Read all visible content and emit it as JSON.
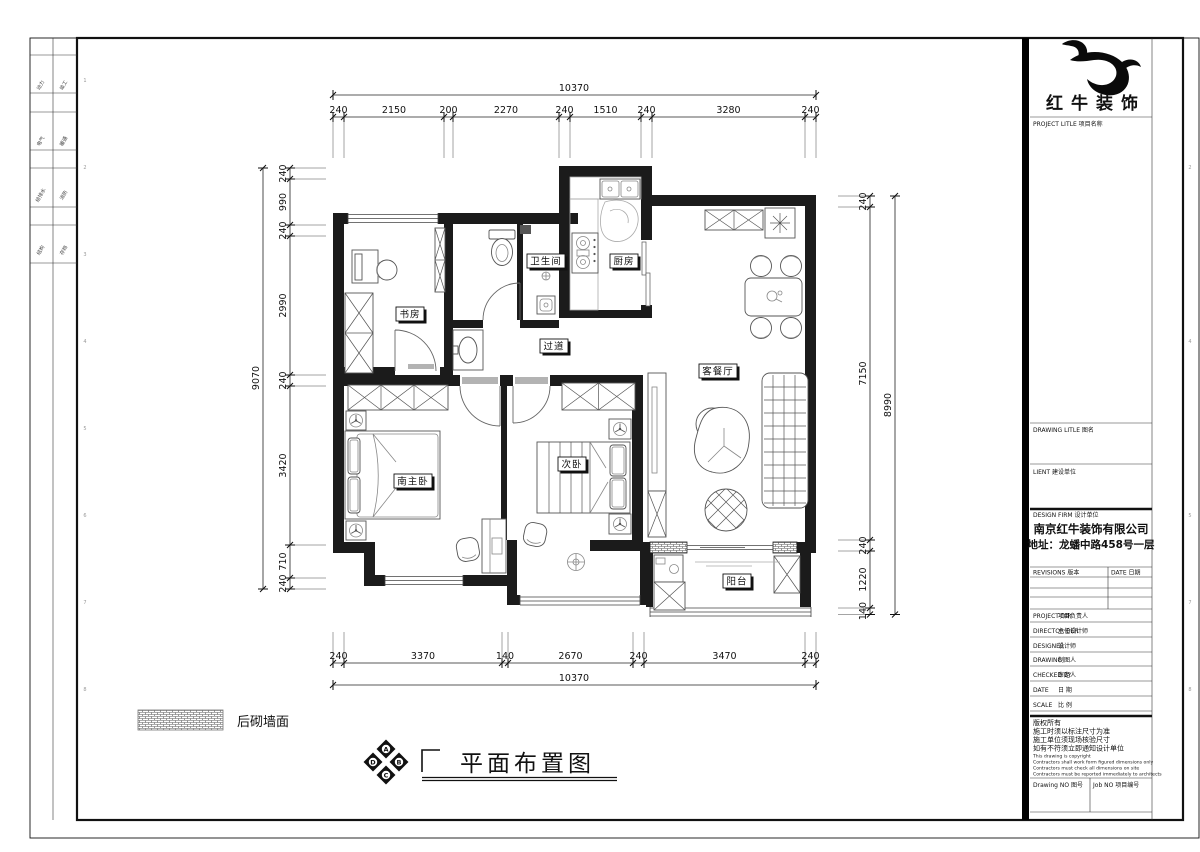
{
  "page": {
    "bg": "#ffffff",
    "line": "#1b1b1b"
  },
  "margins": {
    "numbers": [
      "1",
      "2",
      "3",
      "4",
      "5",
      "6",
      "7",
      "8",
      "9"
    ]
  },
  "left_strip": {
    "cells": [
      {
        "a": "动力",
        "b": "竣工"
      },
      {
        "a": "电气",
        "b": "暖通"
      },
      {
        "a": "给排水",
        "b": "消防"
      },
      {
        "a": "结构",
        "b": "存档"
      }
    ]
  },
  "plan": {
    "rooms": {
      "study": "书房",
      "bath": "卫生间",
      "kitchen": "厨房",
      "hall": "过道",
      "living": "客餐厅",
      "master": "南主卧",
      "second": "次卧",
      "balcony": "阳台"
    },
    "dims": {
      "top_total": "10370",
      "top": [
        "240",
        "2150",
        "200",
        "2270",
        "240",
        "1510",
        "240",
        "3280",
        "240"
      ],
      "bottom": [
        "240",
        "3370",
        "140",
        "2670",
        "240",
        "3470",
        "240"
      ],
      "bottom_total": "10370",
      "left_total": "9070",
      "left": [
        "240",
        "990",
        "240",
        "2990",
        "240",
        "3420",
        "710",
        "240"
      ],
      "right": [
        "240",
        "7150",
        "240",
        "1220",
        "140"
      ],
      "right_total": "8990"
    },
    "legend": {
      "label": "后砌墙面"
    },
    "title": {
      "text": "平面布置图"
    },
    "compass": {
      "n": "A",
      "e": "B",
      "s": "C",
      "w": "D"
    }
  },
  "titleblock": {
    "brand": "红牛装饰",
    "project_title_label": "PROJECT LITLE  项目名称",
    "drawing_title_label": "DRAWING LITLE  图名",
    "client_label": "LIENT  建设单位",
    "design_firm_label": "DESIGN FIRM  设计单位",
    "company": "南京红牛装饰有限公司",
    "address": "地址：龙蟠中路458号一层",
    "revisions_label": "REVISIONS  版本",
    "date_col_label": "DATE  日期",
    "rows": [
      {
        "en": "PROJECT DIR",
        "cn": "项目负责人"
      },
      {
        "en": "DIRECTOR DER",
        "cn": "主任设计师"
      },
      {
        "en": "DESIGNER",
        "cn": "设计师"
      },
      {
        "en": "DRAWING",
        "cn": "制图人"
      },
      {
        "en": "CHECKED BY",
        "cn": "审定人"
      },
      {
        "en": "DATE",
        "cn": "日  期"
      },
      {
        "en": "SCALE",
        "cn": "比  例"
      }
    ],
    "copyright": [
      "版权所有",
      "施工时须以标注尺寸为准",
      "施工单位须现场核验尺寸",
      "如有不符须立即通知设计单位",
      "This drawing is copyright",
      "Contractors shall work form figured dimensions only",
      "Contractors must check all dimensions on site",
      "Contractors must be reported immediately to architects"
    ],
    "drawing_no_label": "Drawing NO  图号",
    "job_no_label": "Job NO  项目编号"
  }
}
